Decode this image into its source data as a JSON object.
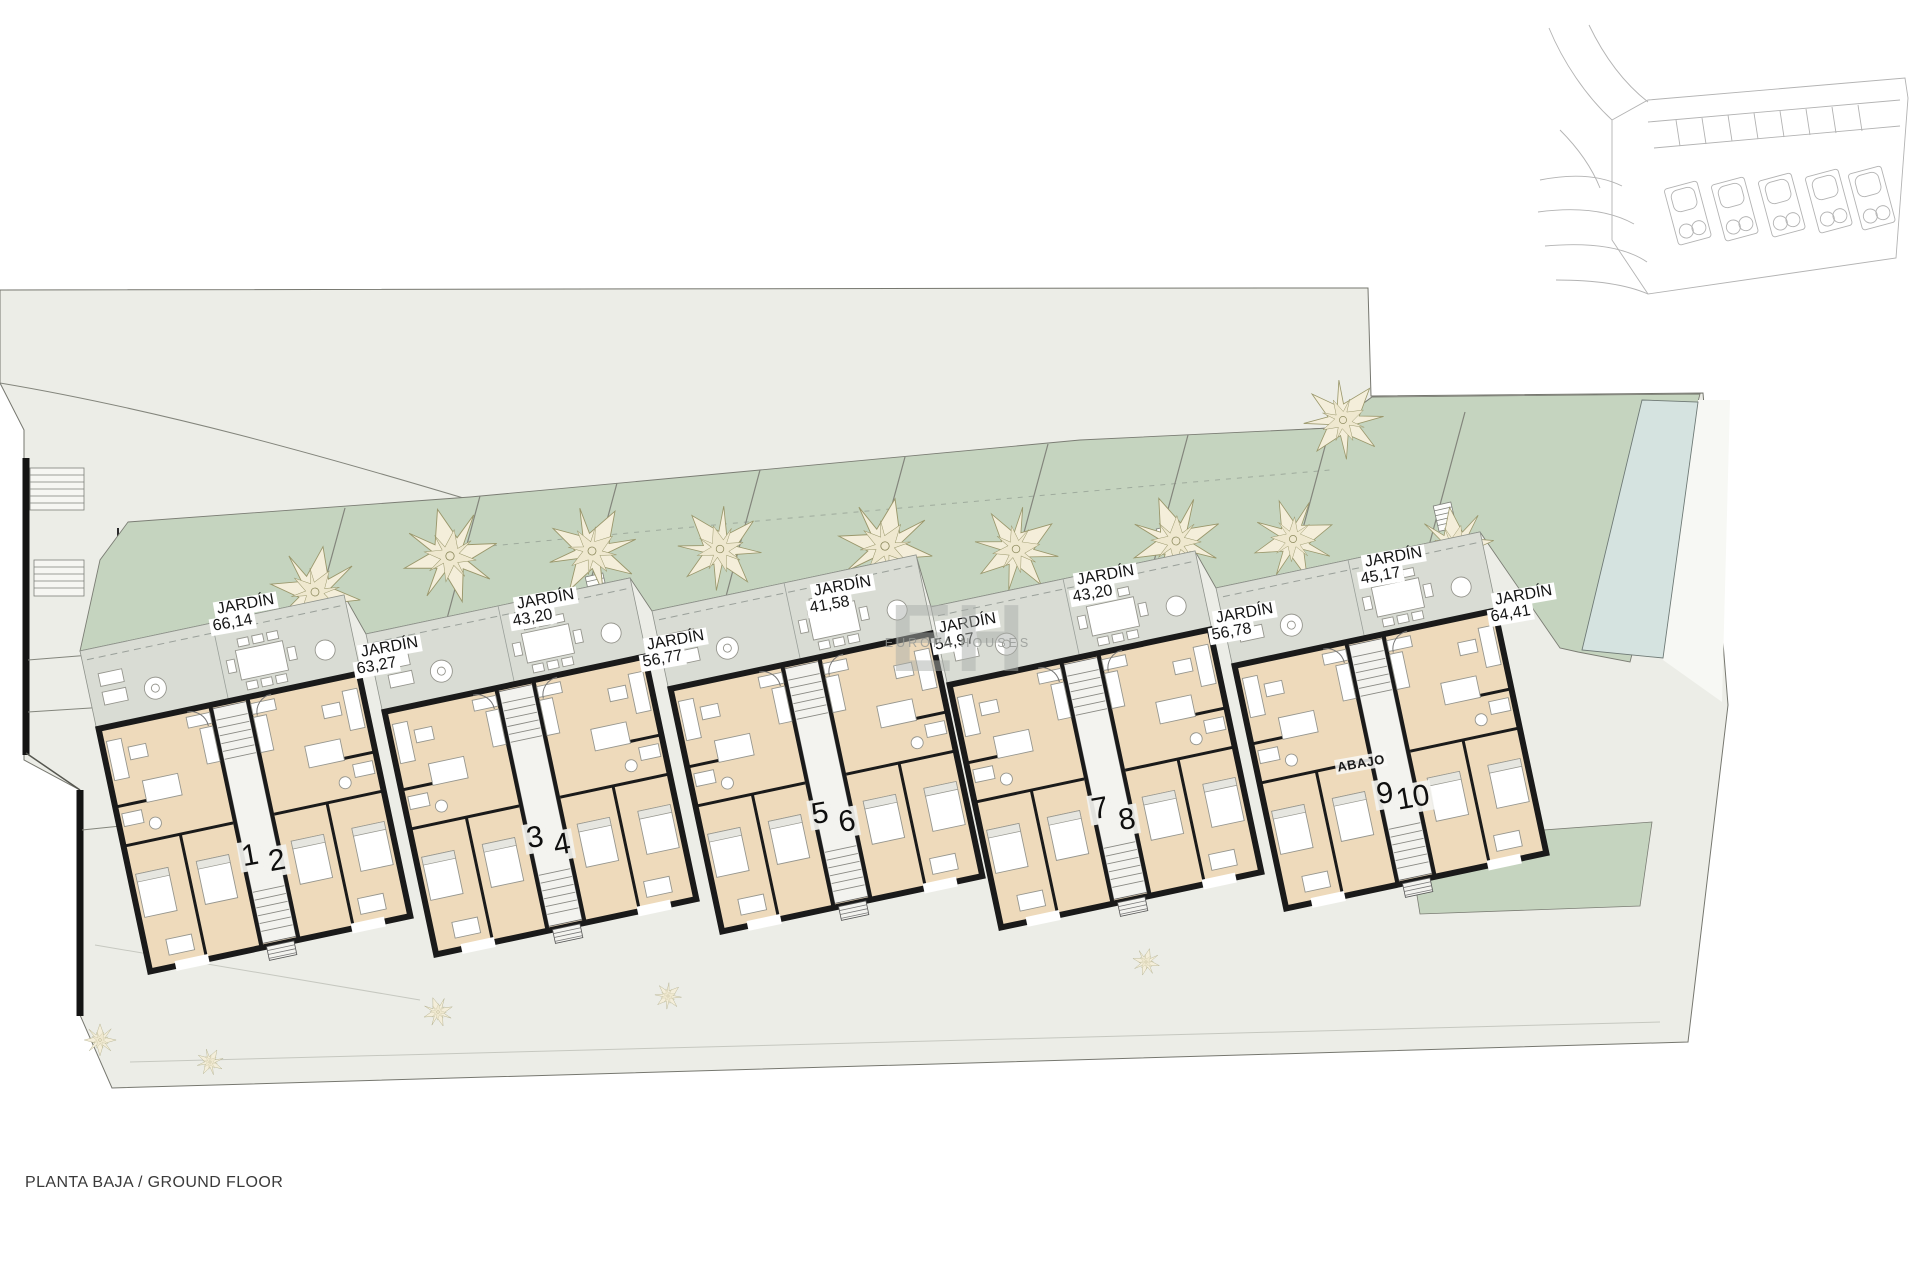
{
  "footer": {
    "text": "PLANTA BAJA / GROUND FLOOR"
  },
  "watermark": {
    "initials": "EH",
    "name": "EUROPA HOUSES"
  },
  "abajo": {
    "text": "ABAJO"
  },
  "gardens": [
    {
      "name": "JARDÍN",
      "area": "66,14"
    },
    {
      "name": "JARDÍN",
      "area": "63,27"
    },
    {
      "name": "JARDÍN",
      "area": "43,20"
    },
    {
      "name": "JARDÍN",
      "area": "56,77"
    },
    {
      "name": "JARDÍN",
      "area": "41,58"
    },
    {
      "name": "JARDÍN",
      "area": "54,97"
    },
    {
      "name": "JARDÍN",
      "area": "43,20"
    },
    {
      "name": "JARDÍN",
      "area": "56,78"
    },
    {
      "name": "JARDÍN",
      "area": "45,17"
    },
    {
      "name": "JARDÍN",
      "area": "64,41"
    }
  ],
  "units": [
    "1",
    "2",
    "3",
    "4",
    "5",
    "6",
    "7",
    "8",
    "9",
    "10"
  ],
  "colors": {
    "pave": "#ecede7",
    "garden": "#c5d4bf",
    "pool": "#d5e3e0",
    "floor": "#eedabb",
    "terrace": "#d9dcd4",
    "wall": "#1a1a1a"
  }
}
